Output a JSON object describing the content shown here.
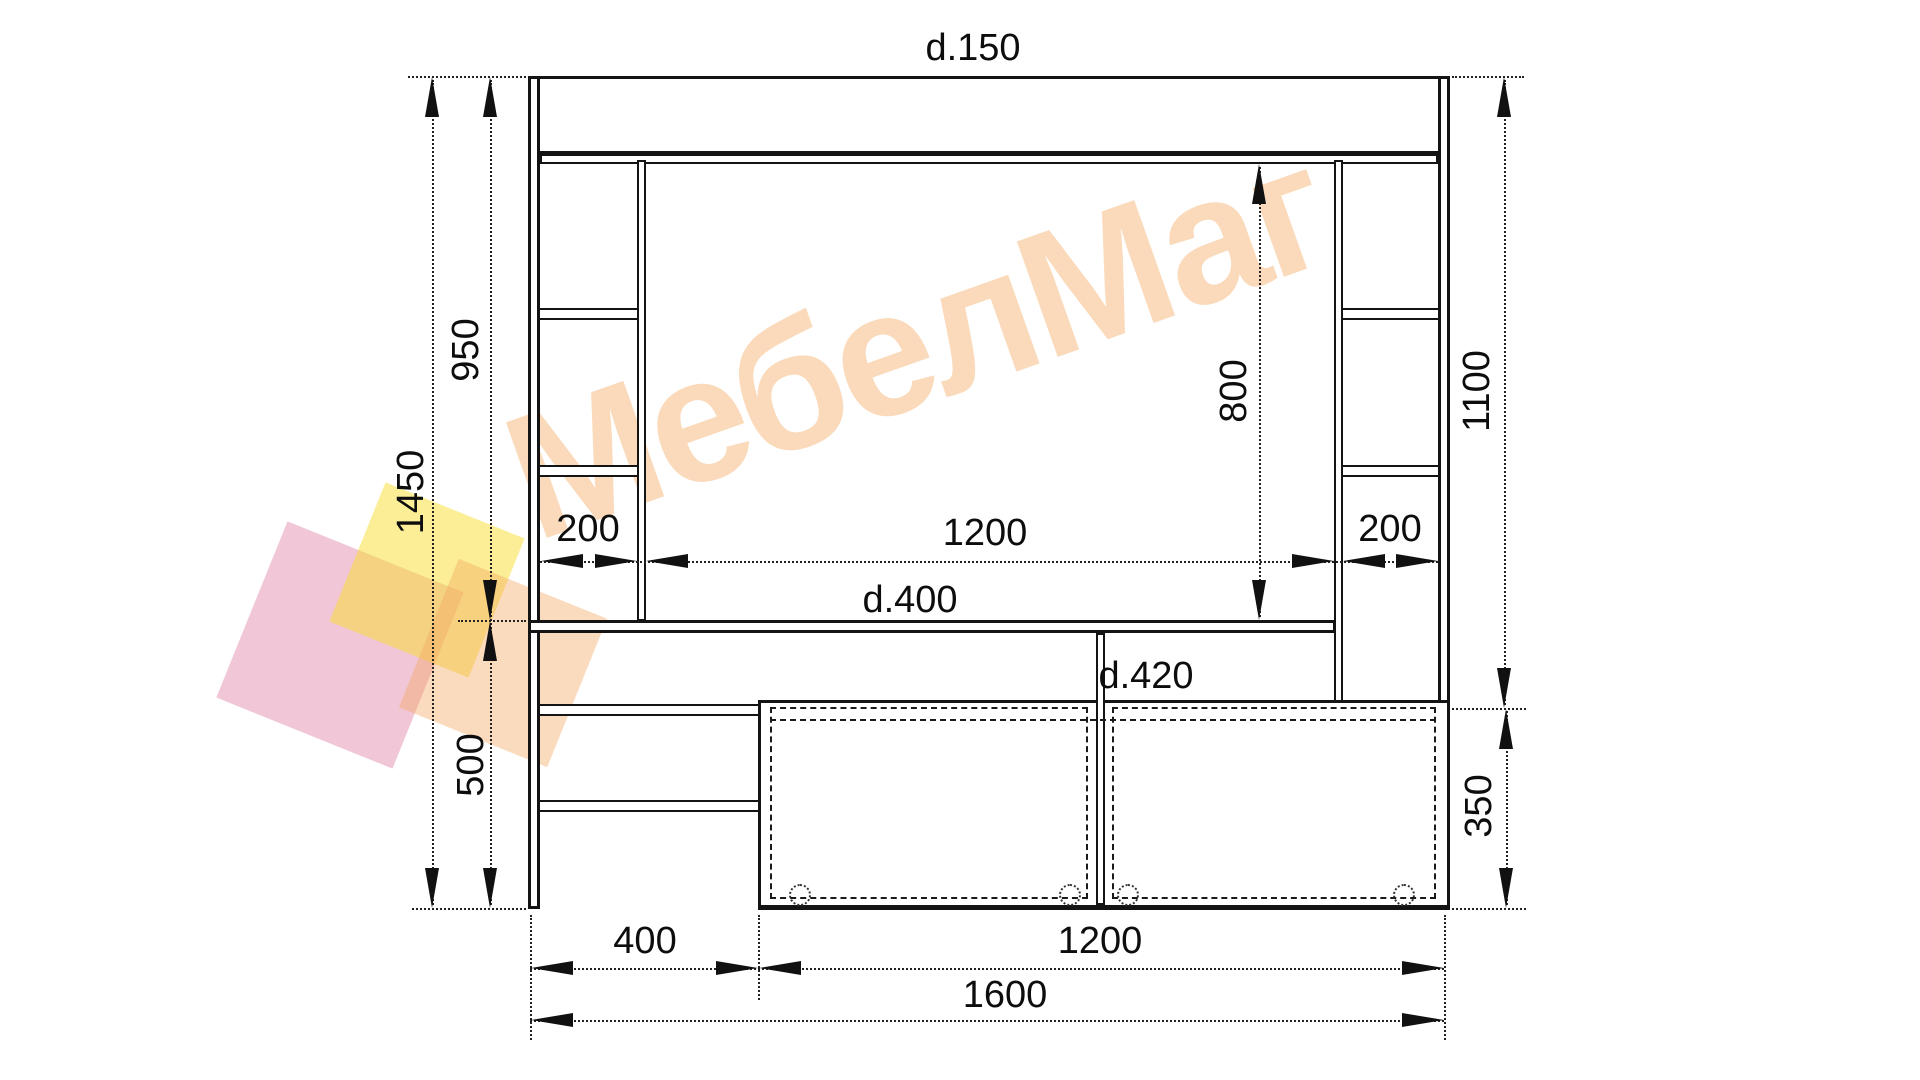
{
  "drawing": {
    "type": "furniture front-view technical drawing",
    "item": "wall unit with desk, shelf columns and TV stand"
  },
  "watermark": {
    "text": "МебелМаг",
    "text_color": "rgba(243,157,74,0.38)",
    "square_colors": {
      "pink": "rgba(221,116,155,0.40)",
      "yellow": "rgba(248,222,46,0.50)",
      "peach": "rgba(244,166,92,0.40)"
    }
  },
  "dimensions": {
    "top_depth": "d.150",
    "total_height": "1450",
    "upper_height": "950",
    "lower_height": "500",
    "left_column_width": "200",
    "niche_width": "1200",
    "right_column_width": "200",
    "niche_height": "800",
    "right_height": "1100",
    "desk_depth": "d.400",
    "cabinet_depth": "d.420",
    "cabinet_height": "350",
    "bottom_left_width": "400",
    "cabinet_width": "1200",
    "total_width": "1600"
  },
  "colors": {
    "line": "#141414",
    "dimension": "#222222",
    "background": "#ffffff"
  }
}
